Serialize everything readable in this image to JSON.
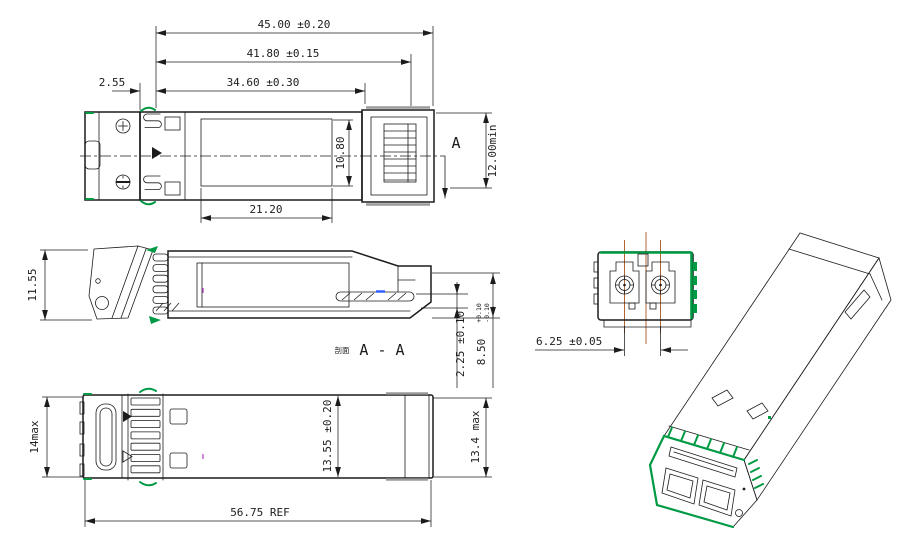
{
  "drawing": {
    "type": "engineering-drawing",
    "subject": "SFP optical transceiver module, multi-view dimensioned drawing",
    "labels": {
      "cut_marker": "A",
      "section_prefix": "剖面",
      "section_name": "A - A"
    },
    "dims": {
      "d45": "45.00 ±0.20",
      "d41_8": "41.80 ±0.15",
      "d34_6": "34.60 ±0.30",
      "d2_55": "2.55",
      "d21_2": "21.20",
      "d10_8": "10.80",
      "d12min": "12.00min",
      "d11_55": "11.55",
      "d2_25": "2.25 ±0.10",
      "d8_5": "8.50",
      "d8_5_tol_plus": "+0.10",
      "d8_5_tol_minus": "-0.10",
      "d14max": "14max",
      "d13_55": "13.55 ±0.20",
      "d13_4": "13.4 max",
      "d56_75": "56.75 REF",
      "d6_25": "6.25 ±0.05"
    },
    "colors": {
      "line": "#1c1c1c",
      "accent_green": "#009a44",
      "centerline_orange": "#b06430",
      "highlight_blue": "#2b5cff",
      "mark_purple": "#b040c0",
      "shade_gray": "#9a9a9a",
      "background": "#ffffff"
    }
  }
}
